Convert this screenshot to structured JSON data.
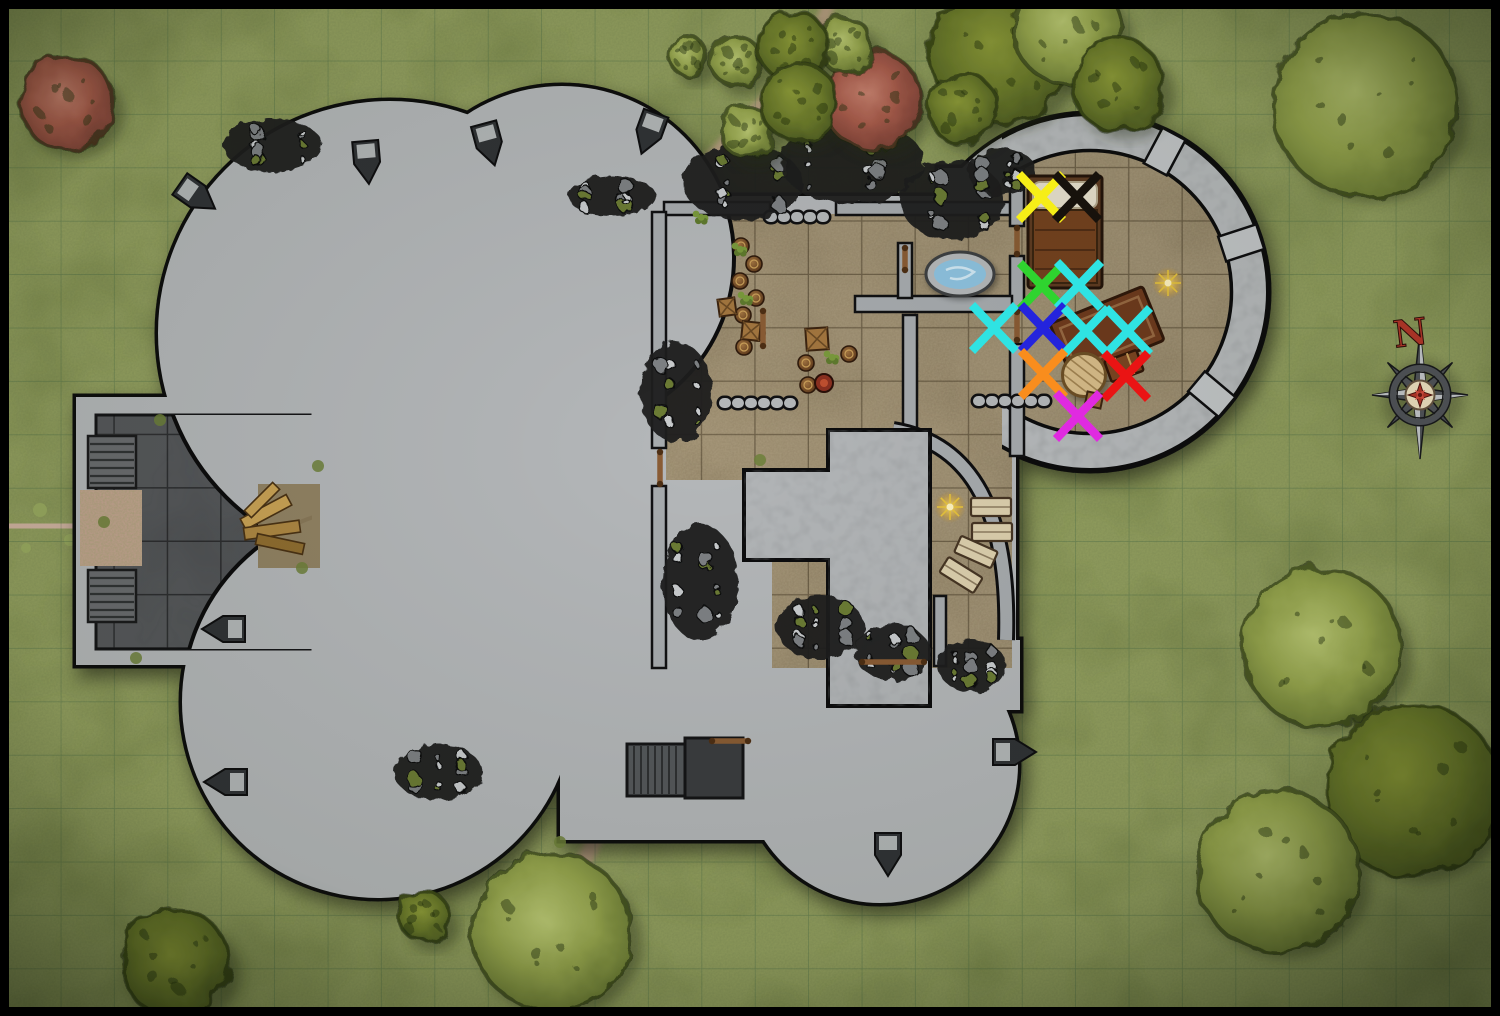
{
  "map": {
    "compass": {
      "label": "N",
      "x": 1420,
      "y": 395,
      "needle_color": "#a63326",
      "metal_color": "#4b4e52"
    },
    "grid": {
      "size": 53.4,
      "origin": 8,
      "line_color": "#2a5a40"
    },
    "frame_color": "#000000",
    "palette": {
      "grass": "#8d9a5d",
      "grass_dark": "#55652f",
      "stone": "#b4b7b9",
      "stone_dark": "#3f4144",
      "courtyard": "#55575a",
      "floor_tan": "#9c8d70",
      "wood": "#8a5c34",
      "water": "#8ec3e0",
      "rubble": "#1c1e20",
      "path": "#c4a591"
    },
    "marks": [
      {
        "id": "yellow",
        "color": "#f6ee17",
        "x": 1041,
        "y": 197
      },
      {
        "id": "black",
        "color": "#17120c",
        "x": 1077,
        "y": 197
      },
      {
        "id": "green",
        "color": "#2fd42f",
        "x": 1042,
        "y": 286
      },
      {
        "id": "cyan-1",
        "color": "#2fe3e3",
        "x": 1079,
        "y": 285
      },
      {
        "id": "cyan-2",
        "color": "#2fe3e3",
        "x": 994,
        "y": 328
      },
      {
        "id": "blue",
        "color": "#2424dd",
        "x": 1043,
        "y": 328
      },
      {
        "id": "cyan-3",
        "color": "#2fe3e3",
        "x": 1086,
        "y": 331
      },
      {
        "id": "cyan-4",
        "color": "#2fe3e3",
        "x": 1128,
        "y": 331
      },
      {
        "id": "orange",
        "color": "#f98d1d",
        "x": 1043,
        "y": 374
      },
      {
        "id": "red",
        "color": "#ea1414",
        "x": 1126,
        "y": 376
      },
      {
        "id": "magenta",
        "color": "#e02ae0",
        "x": 1078,
        "y": 416
      }
    ],
    "trees": [
      {
        "x": 67,
        "y": 103,
        "r": 48,
        "tone": "red"
      },
      {
        "x": 872,
        "y": 100,
        "r": 50,
        "tone": "red"
      },
      {
        "x": 688,
        "y": 56,
        "r": 20,
        "tone": "light"
      },
      {
        "x": 736,
        "y": 61,
        "r": 26,
        "tone": "light"
      },
      {
        "x": 845,
        "y": 45,
        "r": 28,
        "tone": "light"
      },
      {
        "x": 748,
        "y": 133,
        "r": 27,
        "tone": "light"
      },
      {
        "x": 793,
        "y": 46,
        "r": 36,
        "tone": "dark"
      },
      {
        "x": 799,
        "y": 102,
        "r": 40,
        "tone": "dark"
      },
      {
        "x": 1000,
        "y": 55,
        "r": 70,
        "tone": "dark"
      },
      {
        "x": 1068,
        "y": 30,
        "r": 55,
        "tone": "light"
      },
      {
        "x": 1118,
        "y": 85,
        "r": 47,
        "tone": "dark"
      },
      {
        "x": 962,
        "y": 108,
        "r": 36,
        "tone": "dark"
      },
      {
        "x": 1365,
        "y": 105,
        "r": 93,
        "tone": "light"
      },
      {
        "x": 1322,
        "y": 648,
        "r": 80,
        "tone": "light"
      },
      {
        "x": 1412,
        "y": 790,
        "r": 88,
        "tone": "dark"
      },
      {
        "x": 1278,
        "y": 872,
        "r": 82,
        "tone": "light"
      },
      {
        "x": 552,
        "y": 932,
        "r": 80,
        "tone": "light"
      },
      {
        "x": 424,
        "y": 916,
        "r": 26,
        "tone": "dark"
      },
      {
        "x": 175,
        "y": 963,
        "r": 55,
        "tone": "dark"
      }
    ],
    "rubble": [
      {
        "x": 272,
        "y": 145,
        "rx": 50,
        "ry": 26
      },
      {
        "x": 612,
        "y": 196,
        "rx": 44,
        "ry": 20
      },
      {
        "x": 742,
        "y": 182,
        "rx": 60,
        "ry": 38
      },
      {
        "x": 852,
        "y": 162,
        "rx": 72,
        "ry": 42
      },
      {
        "x": 952,
        "y": 200,
        "rx": 52,
        "ry": 40
      },
      {
        "x": 1002,
        "y": 172,
        "rx": 34,
        "ry": 24
      },
      {
        "x": 676,
        "y": 392,
        "rx": 36,
        "ry": 50
      },
      {
        "x": 700,
        "y": 582,
        "rx": 38,
        "ry": 58
      },
      {
        "x": 820,
        "y": 627,
        "rx": 44,
        "ry": 32
      },
      {
        "x": 892,
        "y": 652,
        "rx": 38,
        "ry": 28
      },
      {
        "x": 972,
        "y": 666,
        "rx": 34,
        "ry": 26
      },
      {
        "x": 438,
        "y": 772,
        "rx": 44,
        "ry": 28
      }
    ],
    "slits": [
      {
        "x": 197,
        "y": 196,
        "rot": 35
      },
      {
        "x": 367,
        "y": 162,
        "rot": 85
      },
      {
        "x": 489,
        "y": 144,
        "rot": 75
      },
      {
        "x": 649,
        "y": 133,
        "rot": 110
      },
      {
        "x": 224,
        "y": 629,
        "rot": 180
      },
      {
        "x": 226,
        "y": 782,
        "rot": 180
      },
      {
        "x": 1014,
        "y": 752,
        "rot": 0
      },
      {
        "x": 888,
        "y": 854,
        "rot": 90
      }
    ],
    "props": {
      "barrels": [
        [
          741,
          246
        ],
        [
          754,
          264
        ],
        [
          740,
          281
        ],
        [
          756,
          298
        ],
        [
          743,
          315
        ],
        [
          757,
          333
        ],
        [
          744,
          347
        ],
        [
          806,
          363
        ],
        [
          849,
          354
        ],
        [
          808,
          385
        ]
      ],
      "crates": [
        [
          727,
          307,
          17,
          -8
        ],
        [
          751,
          331,
          18,
          6
        ],
        [
          817,
          339,
          22,
          -4
        ]
      ],
      "plants": [
        [
          739,
          250
        ],
        [
          831,
          358
        ],
        [
          745,
          299
        ],
        [
          700,
          218
        ]
      ],
      "pews": [
        [
          991,
          507,
          0
        ],
        [
          992,
          532,
          0
        ],
        [
          976,
          552,
          24
        ],
        [
          961,
          575,
          32
        ]
      ],
      "sparkles": [
        [
          1168,
          283
        ],
        [
          950,
          507
        ]
      ],
      "shields": [
        [
          824,
          383
        ]
      ],
      "doors": [
        [
          763,
          311,
          763,
          346
        ],
        [
          712,
          741,
          748,
          741
        ],
        [
          862,
          662,
          924,
          662
        ],
        [
          660,
          452,
          660,
          484
        ],
        [
          905,
          248,
          905,
          270
        ],
        [
          1017,
          228,
          1017,
          254
        ],
        [
          1017,
          312,
          1017,
          340
        ]
      ],
      "planks": [
        [
          266,
          512,
          52,
          12,
          -28
        ],
        [
          272,
          530,
          56,
          12,
          -8
        ],
        [
          280,
          544,
          48,
          11,
          12
        ],
        [
          262,
          500,
          40,
          10,
          -45
        ]
      ],
      "tufts": [
        [
          104,
          522
        ],
        [
          160,
          420
        ],
        [
          302,
          568
        ],
        [
          136,
          658
        ],
        [
          318,
          466
        ],
        [
          560,
          842
        ],
        [
          760,
          460
        ]
      ]
    }
  }
}
